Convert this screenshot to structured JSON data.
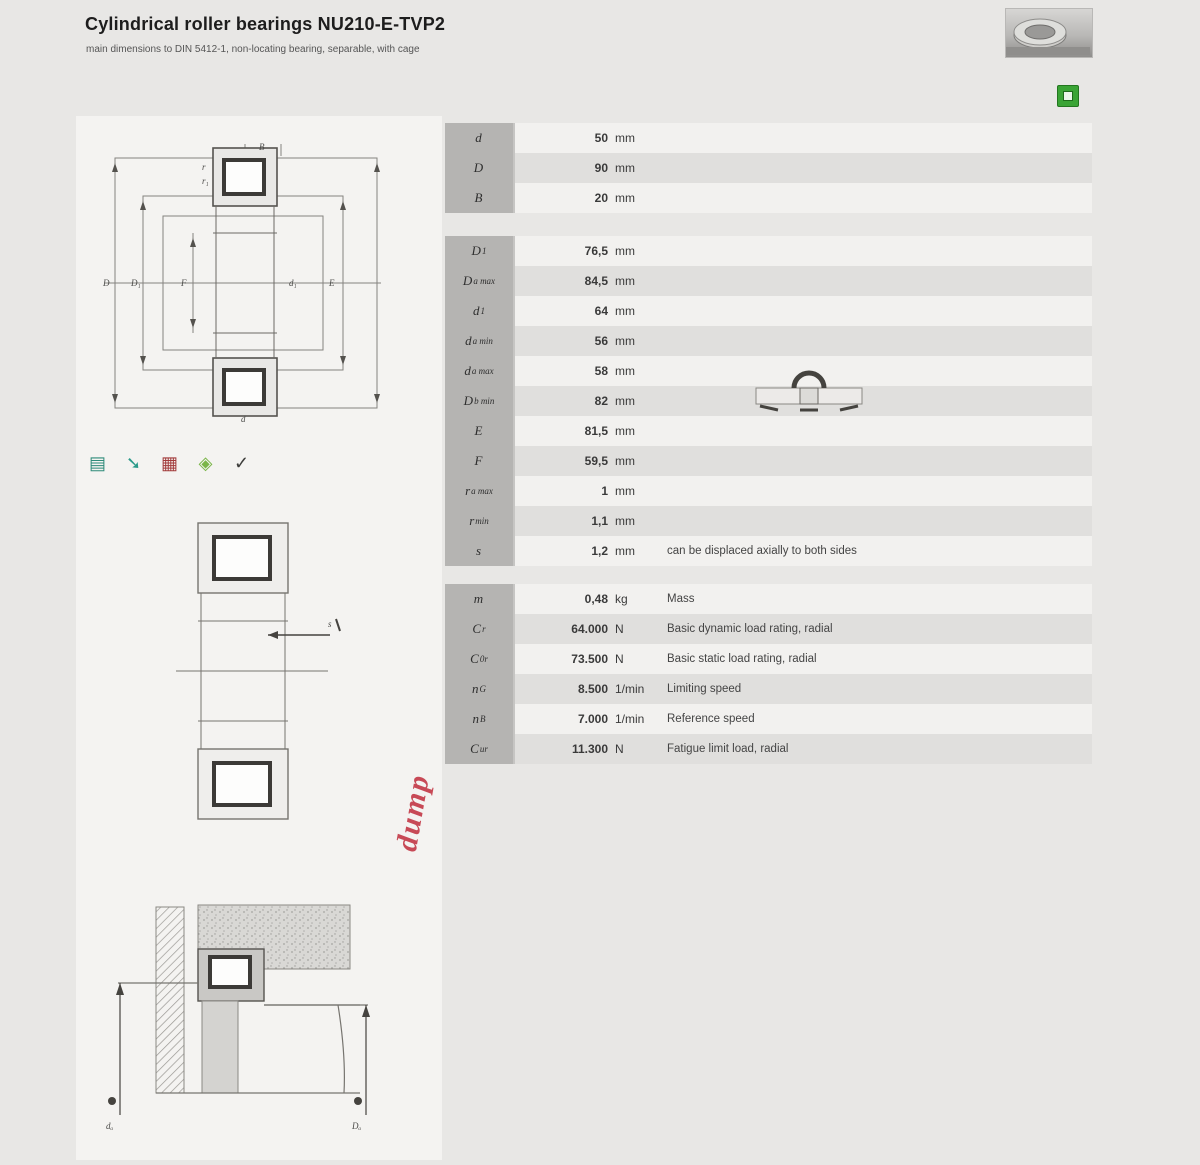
{
  "header": {
    "title": "Cylindrical roller bearings NU210-E-TVP2",
    "subtitle": "main dimensions to DIN 5412-1, non-locating bearing, separable, with cage"
  },
  "toolbar": {
    "icons": [
      {
        "name": "catalogue-icon",
        "glyph": "▤",
        "color": "#2e8b7a"
      },
      {
        "name": "link-arrow-icon",
        "glyph": "➘",
        "color": "#2a9a8a"
      },
      {
        "name": "pdf-table-icon",
        "glyph": "▦",
        "color": "#a23b3b"
      },
      {
        "name": "cad-icon",
        "glyph": "◈",
        "color": "#7ab648"
      },
      {
        "name": "download-icon",
        "glyph": "✓",
        "color": "#3d3d3b"
      }
    ]
  },
  "watermark": "dump",
  "colors": {
    "accent_green": "#3aa435",
    "watermark_red": "#c02c3c",
    "stripe_dark": "#e0dfdd",
    "stripe_light": "#f2f1ef",
    "symbol_cell": "#b5b4b2"
  },
  "tables": {
    "main": {
      "rows": [
        {
          "base": "d",
          "sub": "",
          "value": "50",
          "unit": "mm",
          "note": ""
        },
        {
          "base": "D",
          "sub": "",
          "value": "90",
          "unit": "mm",
          "note": ""
        },
        {
          "base": "B",
          "sub": "",
          "value": "20",
          "unit": "mm",
          "note": ""
        }
      ]
    },
    "dimensions": {
      "rows": [
        {
          "base": "D",
          "sub": "1",
          "value": "76,5",
          "unit": "mm",
          "note": ""
        },
        {
          "base": "D",
          "sub": "a max",
          "value": "84,5",
          "unit": "mm",
          "note": ""
        },
        {
          "base": "d",
          "sub": "1",
          "value": "64",
          "unit": "mm",
          "note": ""
        },
        {
          "base": "d",
          "sub": "a min",
          "value": "56",
          "unit": "mm",
          "note": ""
        },
        {
          "base": "d",
          "sub": "a max",
          "value": "58",
          "unit": "mm",
          "note": ""
        },
        {
          "base": "D",
          "sub": "b min",
          "value": "82",
          "unit": "mm",
          "note": ""
        },
        {
          "base": "E",
          "sub": "",
          "value": "81,5",
          "unit": "mm",
          "note": ""
        },
        {
          "base": "F",
          "sub": "",
          "value": "59,5",
          "unit": "mm",
          "note": ""
        },
        {
          "base": "r",
          "sub": "a max",
          "value": "1",
          "unit": "mm",
          "note": ""
        },
        {
          "base": "r",
          "sub": "min",
          "value": "1,1",
          "unit": "mm",
          "note": ""
        },
        {
          "base": "s",
          "sub": "",
          "value": "1,2",
          "unit": "mm",
          "note": "can be displaced axially to both sides"
        }
      ]
    },
    "performance": {
      "rows": [
        {
          "base": "m",
          "sub": "",
          "value": "0,48",
          "unit": "kg",
          "note": "Mass"
        },
        {
          "base": "C",
          "sub": "r",
          "value": "64.000",
          "unit": "N",
          "note": "Basic dynamic load rating, radial"
        },
        {
          "base": "C",
          "sub": "0r",
          "value": "73.500",
          "unit": "N",
          "note": "Basic static load rating, radial"
        },
        {
          "base": "n",
          "sub": "G",
          "value": "8.500",
          "unit": "1/min",
          "note": "Limiting speed"
        },
        {
          "base": "n",
          "sub": "B",
          "value": "7.000",
          "unit": "1/min",
          "note": "Reference speed"
        },
        {
          "base": "C",
          "sub": "ur",
          "value": "11.300",
          "unit": "N",
          "note": "Fatigue limit load, radial"
        }
      ]
    }
  },
  "drawings": {
    "main": {
      "top": "B",
      "bottom": "d",
      "left_outer": "D",
      "left_mid": "D₁",
      "left_inner": "F",
      "right_inner": "d₁",
      "right_mid": "E",
      "r1": "r",
      "r2": "r₁"
    },
    "section": {
      "arrow_label": "s"
    },
    "mounting": {
      "left": "dₐ",
      "right": "Dₐ"
    }
  }
}
